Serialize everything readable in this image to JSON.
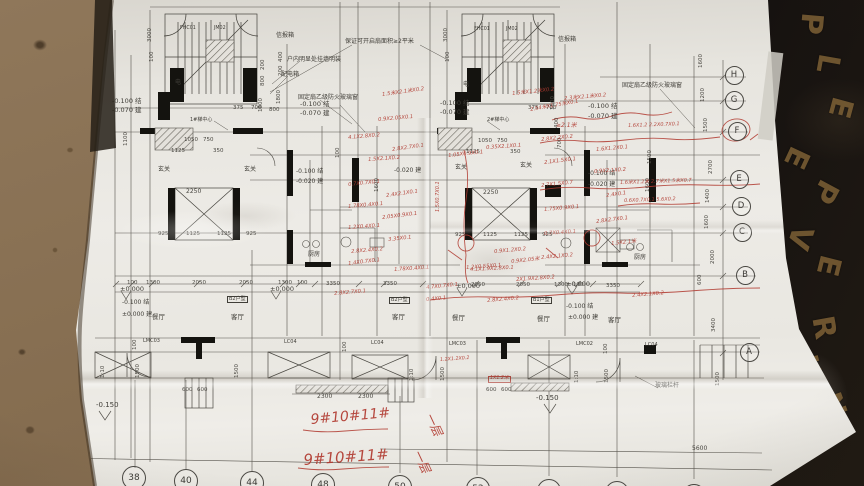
{
  "colors": {
    "paper": "#eceae5",
    "ink": "#4a4842",
    "wall": "#141411",
    "red_marker": "#b13a30",
    "dirt": "#8a7254",
    "board": "#1b1611",
    "board_gold": "#8a6a3a"
  },
  "grid": {
    "right_letters": [
      {
        "t": "H",
        "x": 733,
        "y": 74
      },
      {
        "t": "G",
        "x": 733,
        "y": 99
      },
      {
        "t": "F",
        "x": 736,
        "y": 130
      },
      {
        "t": "E",
        "x": 738,
        "y": 178
      },
      {
        "t": "D",
        "x": 740,
        "y": 205
      },
      {
        "t": "C",
        "x": 741,
        "y": 231
      },
      {
        "t": "B",
        "x": 744,
        "y": 274
      },
      {
        "t": "A",
        "x": 748,
        "y": 351
      }
    ],
    "bottom_numbers": [
      {
        "t": "38",
        "x": 133,
        "y": 477
      },
      {
        "t": "40",
        "x": 185,
        "y": 480
      },
      {
        "t": "44",
        "x": 251,
        "y": 482
      },
      {
        "t": "48",
        "x": 322,
        "y": 484
      },
      {
        "t": "50",
        "x": 399,
        "y": 486
      },
      {
        "t": "52",
        "x": 477,
        "y": 488
      },
      {
        "t": "54",
        "x": 548,
        "y": 490
      },
      {
        "t": "56",
        "x": 616,
        "y": 492
      },
      {
        "t": "58",
        "x": 693,
        "y": 495
      }
    ]
  },
  "board_letters": [
    {
      "t": "P",
      "x": 800,
      "y": 6,
      "r": 95
    },
    {
      "t": "L",
      "x": 818,
      "y": 46,
      "r": 100
    },
    {
      "t": "E",
      "x": 830,
      "y": 90,
      "r": 105
    },
    {
      "t": "E",
      "x": 786,
      "y": 140,
      "r": 115
    },
    {
      "t": "P",
      "x": 814,
      "y": 174,
      "r": 118
    },
    {
      "t": "V",
      "x": 788,
      "y": 220,
      "r": 108
    },
    {
      "t": "E",
      "x": 818,
      "y": 248,
      "r": 104
    },
    {
      "t": "R",
      "x": 812,
      "y": 310,
      "r": 80
    },
    {
      "t": "U",
      "x": 796,
      "y": 350,
      "r": 75
    },
    {
      "t": "N",
      "x": 820,
      "y": 388,
      "r": 70
    }
  ],
  "annotations": {
    "black": [
      {
        "t": "信报箱",
        "x": 276,
        "y": 33,
        "s": 6
      },
      {
        "t": "信报箱",
        "x": 558,
        "y": 37,
        "s": 6
      },
      {
        "t": "保证可开启扇面积≥2平米",
        "x": 345,
        "y": 39,
        "s": 6
      },
      {
        "t": "户内明显处挂墙明装",
        "x": 287,
        "y": 57,
        "s": 6
      },
      {
        "t": "配电箱",
        "x": 281,
        "y": 72,
        "s": 6
      },
      {
        "t": "固定扇乙级防火玻璃窗",
        "x": 298,
        "y": 95,
        "s": 6
      },
      {
        "t": "固定扇乙级防火玻璃窗",
        "x": 622,
        "y": 83,
        "s": 6
      },
      {
        "t": "-0.100 结",
        "x": 112,
        "y": 98,
        "s": 6.5
      },
      {
        "t": "-0.070 建",
        "x": 112,
        "y": 107,
        "s": 6.5
      },
      {
        "t": "-0.100 结",
        "x": 300,
        "y": 101,
        "s": 6.5
      },
      {
        "t": "-0.070 建",
        "x": 300,
        "y": 110,
        "s": 6.5
      },
      {
        "t": "-0.100 结",
        "x": 440,
        "y": 100,
        "s": 6.5
      },
      {
        "t": "-0.070 建",
        "x": 440,
        "y": 109,
        "s": 6.5
      },
      {
        "t": "-0.100 结",
        "x": 588,
        "y": 103,
        "s": 6.5
      },
      {
        "t": "-0.070 建",
        "x": 588,
        "y": 113,
        "s": 6.5
      },
      {
        "t": "FHC01",
        "x": 180,
        "y": 27,
        "s": 4.8
      },
      {
        "t": "JM02",
        "x": 214,
        "y": 27,
        "s": 4.8
      },
      {
        "t": "FHC01",
        "x": 474,
        "y": 28,
        "s": 4.8
      },
      {
        "t": "JM02",
        "x": 506,
        "y": 28,
        "s": 4.8
      },
      {
        "t": "1#梯中心",
        "x": 190,
        "y": 118,
        "s": 5
      },
      {
        "t": "2#梯中心",
        "x": 487,
        "y": 118,
        "s": 5
      },
      {
        "t": "电",
        "x": 175,
        "y": 80,
        "s": 6
      },
      {
        "t": "电",
        "x": 463,
        "y": 82,
        "s": 6
      },
      {
        "t": "玄关",
        "x": 158,
        "y": 167,
        "s": 6
      },
      {
        "t": "玄关",
        "x": 244,
        "y": 167,
        "s": 6
      },
      {
        "t": "玄关",
        "x": 455,
        "y": 165,
        "s": 6
      },
      {
        "t": "玄关",
        "x": 520,
        "y": 163,
        "s": 6
      },
      {
        "t": "-0.100 结",
        "x": 296,
        "y": 169,
        "s": 6
      },
      {
        "t": "-0.020 建",
        "x": 296,
        "y": 179,
        "s": 6
      },
      {
        "t": "-0.100 结",
        "x": 588,
        "y": 171,
        "s": 6
      },
      {
        "t": "-0.020 建",
        "x": 588,
        "y": 182,
        "s": 6
      },
      {
        "t": "-0.020 建",
        "x": 394,
        "y": 168,
        "s": 6
      },
      {
        "t": "厨房",
        "x": 308,
        "y": 252,
        "s": 6
      },
      {
        "t": "厨房",
        "x": 634,
        "y": 255,
        "s": 6
      },
      {
        "t": "餐厅",
        "x": 152,
        "y": 314,
        "s": 6.5
      },
      {
        "t": "客厅",
        "x": 231,
        "y": 314,
        "s": 6.5
      },
      {
        "t": "客厅",
        "x": 392,
        "y": 314,
        "s": 6.5
      },
      {
        "t": "餐厅",
        "x": 452,
        "y": 315,
        "s": 6.5
      },
      {
        "t": "餐厅",
        "x": 537,
        "y": 316,
        "s": 6.5
      },
      {
        "t": "客厅",
        "x": 608,
        "y": 317,
        "s": 6.5
      },
      {
        "t": "B2户型",
        "x": 228,
        "y": 297,
        "s": 5,
        "box": 1
      },
      {
        "t": "B2户型",
        "x": 390,
        "y": 298,
        "s": 5,
        "box": 1
      },
      {
        "t": "B1户型",
        "x": 532,
        "y": 298,
        "s": 5,
        "box": 1
      },
      {
        "t": "±0.000",
        "x": 120,
        "y": 286,
        "s": 6.5
      },
      {
        "t": "±0.000",
        "x": 270,
        "y": 286,
        "s": 6.5
      },
      {
        "t": "±0.000",
        "x": 456,
        "y": 283,
        "s": 6.5
      },
      {
        "t": "±0.000",
        "x": 566,
        "y": 281,
        "s": 6.5
      },
      {
        "t": "-0.100 结",
        "x": 122,
        "y": 300,
        "s": 6
      },
      {
        "t": "±0.000 建",
        "x": 122,
        "y": 312,
        "s": 6
      },
      {
        "t": "-0.100 结",
        "x": 566,
        "y": 304,
        "s": 6
      },
      {
        "t": "±0.000 建",
        "x": 568,
        "y": 315,
        "s": 6
      },
      {
        "t": "LMC03",
        "x": 143,
        "y": 339,
        "s": 5
      },
      {
        "t": "LC04",
        "x": 284,
        "y": 340,
        "s": 5
      },
      {
        "t": "LC04",
        "x": 371,
        "y": 341,
        "s": 5
      },
      {
        "t": "LMC03",
        "x": 449,
        "y": 342,
        "s": 5
      },
      {
        "t": "LMC02",
        "x": 576,
        "y": 342,
        "s": 5
      },
      {
        "t": "LC04",
        "x": 645,
        "y": 343,
        "s": 5
      },
      {
        "t": "玻璃栏杆",
        "x": 655,
        "y": 383,
        "s": 6
      },
      {
        "t": "-0.150",
        "x": 536,
        "y": 395,
        "s": 7
      },
      {
        "t": "-0.150",
        "x": 96,
        "y": 402,
        "s": 7
      }
    ],
    "dims": [
      {
        "t": "100",
        "x": 127,
        "y": 281
      },
      {
        "t": "1300",
        "x": 146,
        "y": 281
      },
      {
        "t": "2050",
        "x": 192,
        "y": 281
      },
      {
        "t": "2050",
        "x": 239,
        "y": 281
      },
      {
        "t": "1300",
        "x": 278,
        "y": 281
      },
      {
        "t": "100",
        "x": 297,
        "y": 281
      },
      {
        "t": "3350",
        "x": 326,
        "y": 282
      },
      {
        "t": "3350",
        "x": 383,
        "y": 282
      },
      {
        "t": "2050",
        "x": 471,
        "y": 283
      },
      {
        "t": "2050",
        "x": 516,
        "y": 283
      },
      {
        "t": "1300",
        "x": 554,
        "y": 283
      },
      {
        "t": "100",
        "x": 573,
        "y": 283
      },
      {
        "t": "3350",
        "x": 606,
        "y": 284
      },
      {
        "t": "1050",
        "x": 184,
        "y": 138
      },
      {
        "t": "750",
        "x": 203,
        "y": 138
      },
      {
        "t": "1050",
        "x": 478,
        "y": 139
      },
      {
        "t": "750",
        "x": 497,
        "y": 139
      },
      {
        "t": "1125",
        "x": 171,
        "y": 149
      },
      {
        "t": "350",
        "x": 213,
        "y": 149
      },
      {
        "t": "1125",
        "x": 466,
        "y": 150
      },
      {
        "t": "350",
        "x": 510,
        "y": 150
      },
      {
        "t": "925",
        "x": 158,
        "y": 232
      },
      {
        "t": "1125",
        "x": 186,
        "y": 232
      },
      {
        "t": "1125",
        "x": 217,
        "y": 232
      },
      {
        "t": "925",
        "x": 246,
        "y": 232
      },
      {
        "t": "925",
        "x": 455,
        "y": 233
      },
      {
        "t": "1125",
        "x": 483,
        "y": 233
      },
      {
        "t": "1125",
        "x": 514,
        "y": 233
      },
      {
        "t": "925",
        "x": 542,
        "y": 233
      },
      {
        "t": "2250",
        "x": 186,
        "y": 189,
        "s": 6
      },
      {
        "t": "2250",
        "x": 483,
        "y": 190,
        "s": 6
      },
      {
        "t": "2300",
        "x": 317,
        "y": 394,
        "s": 6
      },
      {
        "t": "2300",
        "x": 358,
        "y": 394,
        "s": 6
      },
      {
        "t": "600",
        "x": 182,
        "y": 388
      },
      {
        "t": "600",
        "x": 197,
        "y": 388
      },
      {
        "t": "600",
        "x": 486,
        "y": 388
      },
      {
        "t": "600",
        "x": 501,
        "y": 388
      },
      {
        "t": "5600",
        "x": 692,
        "y": 446,
        "s": 6
      },
      {
        "t": "375",
        "x": 233,
        "y": 106
      },
      {
        "t": "700",
        "x": 251,
        "y": 106
      },
      {
        "t": "800",
        "x": 269,
        "y": 108
      },
      {
        "t": "375",
        "x": 528,
        "y": 106
      },
      {
        "t": "700",
        "x": 546,
        "y": 106
      },
      {
        "t": "3000",
        "x": 148,
        "y": 42,
        "r": -90
      },
      {
        "t": "100",
        "x": 150,
        "y": 62,
        "r": -90
      },
      {
        "t": "3000",
        "x": 444,
        "y": 42,
        "r": -90
      },
      {
        "t": "100",
        "x": 446,
        "y": 62,
        "r": -90
      },
      {
        "t": "1600",
        "x": 699,
        "y": 68,
        "r": -90
      },
      {
        "t": "1200",
        "x": 701,
        "y": 102,
        "r": -90
      },
      {
        "t": "1500",
        "x": 704,
        "y": 132,
        "r": -90
      },
      {
        "t": "2700",
        "x": 709,
        "y": 174,
        "r": -90
      },
      {
        "t": "1400",
        "x": 706,
        "y": 203,
        "r": -90
      },
      {
        "t": "1600",
        "x": 705,
        "y": 229,
        "r": -90
      },
      {
        "t": "2000",
        "x": 711,
        "y": 264,
        "r": -90
      },
      {
        "t": "600",
        "x": 698,
        "y": 285,
        "r": -90
      },
      {
        "t": "3400",
        "x": 712,
        "y": 332,
        "r": -90
      },
      {
        "t": "1500",
        "x": 716,
        "y": 386,
        "r": -90
      },
      {
        "t": "1500",
        "x": 648,
        "y": 164,
        "r": -90
      },
      {
        "t": "1600",
        "x": 646,
        "y": 192,
        "r": -90
      },
      {
        "t": "400",
        "x": 279,
        "y": 62,
        "r": -90
      },
      {
        "t": "200",
        "x": 279,
        "y": 76,
        "r": -90
      },
      {
        "t": "1800",
        "x": 277,
        "y": 104,
        "r": -90
      },
      {
        "t": "1800",
        "x": 551,
        "y": 110,
        "r": -90
      },
      {
        "t": "400",
        "x": 555,
        "y": 128,
        "r": -90
      },
      {
        "t": "700",
        "x": 558,
        "y": 148,
        "r": -90
      },
      {
        "t": "200",
        "x": 261,
        "y": 70,
        "r": -90
      },
      {
        "t": "800",
        "x": 261,
        "y": 86,
        "r": -90
      },
      {
        "t": "1800",
        "x": 259,
        "y": 112,
        "r": -90
      },
      {
        "t": "1100",
        "x": 124,
        "y": 146,
        "r": -90
      },
      {
        "t": "1600",
        "x": 375,
        "y": 192,
        "r": -90
      },
      {
        "t": "100",
        "x": 336,
        "y": 158,
        "r": -90
      },
      {
        "t": "1:10",
        "x": 101,
        "y": 378,
        "r": -90
      },
      {
        "t": "1500",
        "x": 136,
        "y": 378,
        "r": -90
      },
      {
        "t": "1500",
        "x": 235,
        "y": 378,
        "r": -90
      },
      {
        "t": "1:10",
        "x": 410,
        "y": 381,
        "r": -90
      },
      {
        "t": "1500",
        "x": 441,
        "y": 381,
        "r": -90
      },
      {
        "t": "1:10",
        "x": 575,
        "y": 383,
        "r": -90
      },
      {
        "t": "1500",
        "x": 605,
        "y": 383,
        "r": -90
      },
      {
        "t": "100",
        "x": 133,
        "y": 350,
        "r": -90
      },
      {
        "t": "100",
        "x": 343,
        "y": 352,
        "r": -90
      },
      {
        "t": "100",
        "x": 604,
        "y": 354,
        "r": -90
      }
    ],
    "red": [
      {
        "t": "1.5米X2.1米X0.2",
        "x": 382,
        "y": 93,
        "r": -8
      },
      {
        "t": "1.5米X1.2米X0.2",
        "x": 512,
        "y": 92,
        "r": -6
      },
      {
        "t": "2.54米X1.75米X0.1",
        "x": 530,
        "y": 108,
        "r": -10
      },
      {
        "t": "0.9X2.05X0.1",
        "x": 378,
        "y": 118,
        "r": -5
      },
      {
        "t": "≥2.1米",
        "x": 556,
        "y": 123,
        "s": 6
      },
      {
        "t": "2.3米X2.1米X0.2",
        "x": 564,
        "y": 97,
        "r": -5
      },
      {
        "t": "4.1X2.8X0.2",
        "x": 348,
        "y": 136,
        "r": -5
      },
      {
        "t": "2.8X2.7X0.1",
        "x": 392,
        "y": 148,
        "r": -8
      },
      {
        "t": "1.5X2.1X0.2",
        "x": 368,
        "y": 158,
        "r": -4
      },
      {
        "t": "0.7X0.7X0.1",
        "x": 348,
        "y": 183,
        "r": -6
      },
      {
        "t": "2.4X2.1X0.1",
        "x": 386,
        "y": 194,
        "r": -8
      },
      {
        "t": "1.78X0.4X0.1",
        "x": 348,
        "y": 205,
        "r": -5
      },
      {
        "t": "2.05X0.9X0.1",
        "x": 382,
        "y": 216,
        "r": -7
      },
      {
        "t": "1.2X0.4X0.1",
        "x": 348,
        "y": 226,
        "r": -4
      },
      {
        "t": "3.35X0.1",
        "x": 388,
        "y": 238,
        "r": -6
      },
      {
        "t": "2.8X2.4X0.2",
        "x": 351,
        "y": 250,
        "r": -5
      },
      {
        "t": "1.4X0.7X0.1",
        "x": 348,
        "y": 262,
        "r": -7
      },
      {
        "t": "1.05X0.9X0.1",
        "x": 448,
        "y": 154,
        "r": -6
      },
      {
        "t": "0.35X2.1X0.1",
        "x": 486,
        "y": 146,
        "r": -4
      },
      {
        "t": "1.5X0.7X0.1",
        "x": 436,
        "y": 212,
        "r": -90,
        "s": 5
      },
      {
        "t": "0.9X1.2X0.2",
        "x": 494,
        "y": 250,
        "r": -5
      },
      {
        "t": "1.2X0.55X0.1",
        "x": 466,
        "y": 266,
        "r": -4
      },
      {
        "t": "0.9X2.05米",
        "x": 511,
        "y": 260,
        "r": -6
      },
      {
        "t": "2.8X2.2X0.2",
        "x": 541,
        "y": 138,
        "r": -6
      },
      {
        "t": "1.6X1.2X0.1",
        "x": 596,
        "y": 148,
        "r": -5
      },
      {
        "t": "2.1X1.5X0.1",
        "x": 544,
        "y": 161,
        "r": -7
      },
      {
        "t": "0.9X2.1X0.2",
        "x": 594,
        "y": 170,
        "r": -4
      },
      {
        "t": "2.7X1.5X0.7",
        "x": 541,
        "y": 184,
        "r": -6
      },
      {
        "t": "2.4X0.1",
        "x": 606,
        "y": 194,
        "r": -8
      },
      {
        "t": "1.75X0.9X0.1",
        "x": 544,
        "y": 208,
        "r": -5
      },
      {
        "t": "2.8X2.7X0.1",
        "x": 596,
        "y": 220,
        "r": -7
      },
      {
        "t": "0.7X0.4X0.1",
        "x": 544,
        "y": 232,
        "r": -4
      },
      {
        "t": "1.5X2.1米",
        "x": 611,
        "y": 242,
        "r": -6
      },
      {
        "t": "2.4X2.1X0.2",
        "x": 541,
        "y": 256,
        "r": -5
      },
      {
        "t": "1.6X1.2 2.2X0.7X0.1",
        "x": 628,
        "y": 124,
        "r": -2,
        "s": 5
      },
      {
        "t": "1.6米X1.2米 2.7米X1.5米X0.7",
        "x": 620,
        "y": 181,
        "r": -2,
        "s": 5
      },
      {
        "t": "0.6X0.7X0.1 5.6X0.2",
        "x": 624,
        "y": 199,
        "r": -2,
        "s": 5
      },
      {
        "t": "2.4X2.1X0.2",
        "x": 632,
        "y": 294,
        "r": -5
      },
      {
        "t": "2.8X2.7X0.1",
        "x": 334,
        "y": 292,
        "r": -5
      },
      {
        "t": "1.78X0.4X0.1",
        "x": 394,
        "y": 268,
        "r": -4
      },
      {
        "t": "4.7X0.7X0.1",
        "x": 426,
        "y": 286,
        "r": -6
      },
      {
        "t": "0.4X0.1",
        "x": 426,
        "y": 298,
        "r": -5
      },
      {
        "t": "4.1X1.9X2.8X0.1",
        "x": 470,
        "y": 268,
        "r": -3
      },
      {
        "t": "2.8X2.4X0.2",
        "x": 487,
        "y": 299,
        "r": -5
      },
      {
        "t": "2X1.9X2.8X0.2",
        "x": 516,
        "y": 278,
        "r": -4
      },
      {
        "t": "1.2X1.2X0.2",
        "x": 440,
        "y": 359,
        "r": -4,
        "s": 4.8
      },
      {
        "t": "1X1.2米",
        "x": 489,
        "y": 377,
        "s": 4.8,
        "box": 1
      },
      {
        "t": "9#10#11#",
        "x": 310,
        "y": 413,
        "r": -5,
        "s": 14
      },
      {
        "t": "9#10#11#",
        "x": 303,
        "y": 453,
        "r": -4,
        "s": 15
      },
      {
        "t": "一层",
        "x": 434,
        "y": 411,
        "r": 65,
        "s": 12
      },
      {
        "t": "一层",
        "x": 422,
        "y": 448,
        "r": 65,
        "s": 12
      }
    ]
  }
}
